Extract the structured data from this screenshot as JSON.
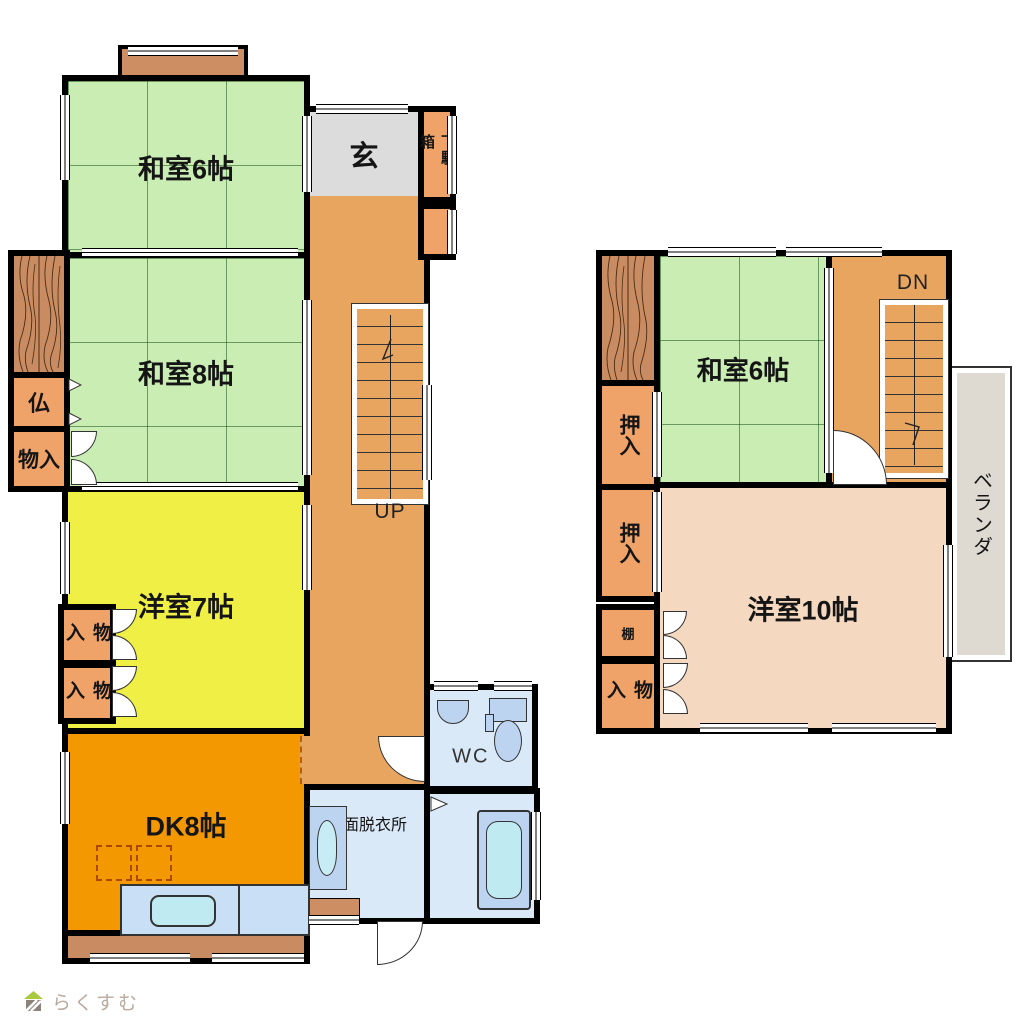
{
  "floor1": {
    "washitsu6": "和室6帖",
    "washitsu8": "和室8帖",
    "yoshitsu7": "洋室7帖",
    "dk": "DK8帖",
    "genkan": "玄",
    "getabako": "下駄箱",
    "butsudan": "仏",
    "monoiri": "物入",
    "monoiri_small": "物入",
    "wc": "WC",
    "senmen": "洗面脱衣所",
    "stairs_up": "UP"
  },
  "floor2": {
    "washitsu6": "和室6帖",
    "oshiire": "押入",
    "tana": "棚",
    "monoiri": "物入",
    "yoshitsu10": "洋室10帖",
    "veranda": "ベランダ",
    "stairs_dn": "DN"
  },
  "logo": {
    "text": "らくすむ"
  },
  "colors": {
    "tatami": "#C9EDB3",
    "hallway": "#E8A55F",
    "closet": "#F0A369",
    "western7": "#EFEF45",
    "dk": "#F39800",
    "western10": "#F4D8C0",
    "water": "#D9E9F8",
    "fixture": "#BCD4F0",
    "entrance": "#DCDCDC",
    "veranda": "#DEDAD2",
    "wood": "#C98C62"
  }
}
